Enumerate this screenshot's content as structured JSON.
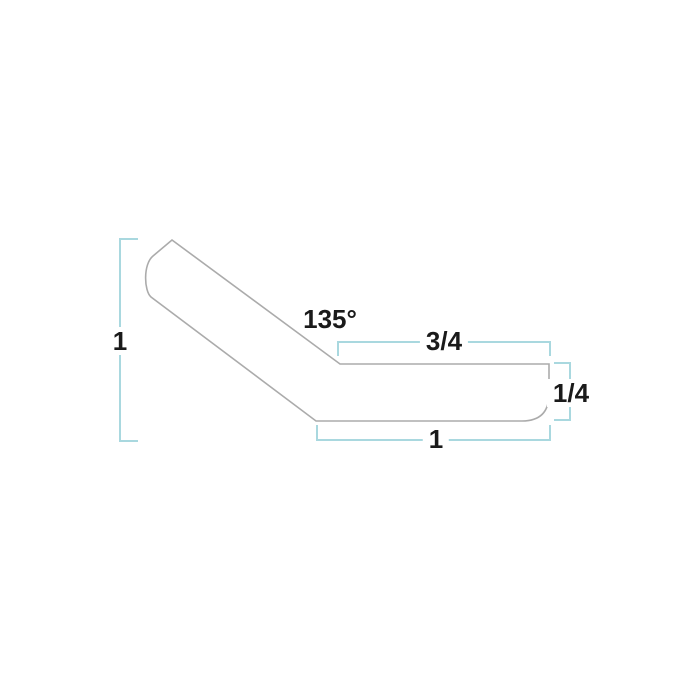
{
  "drawing": {
    "type": "molding-profile-dimension-diagram",
    "labels": {
      "angle": "135°",
      "height": "1",
      "top_width": "3/4",
      "thickness": "1/4",
      "bottom_width": "1"
    },
    "colors": {
      "dimension_line": "#a9d8df",
      "profile_outline": "#ababab",
      "label_text": "#1a1a1a",
      "background": "#ffffff"
    }
  }
}
